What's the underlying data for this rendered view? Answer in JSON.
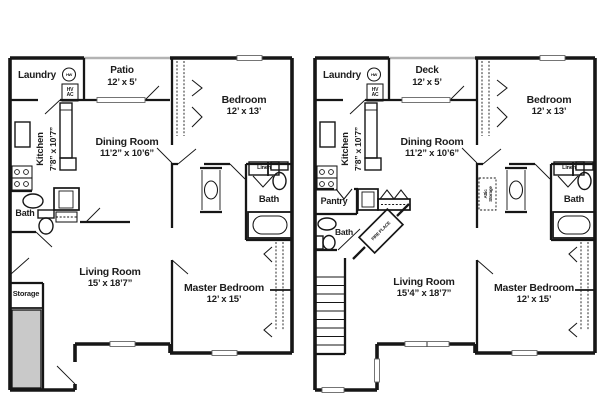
{
  "colors": {
    "background": "#ffffff",
    "walls": "#161616",
    "storage_fill": "#c9c9c9",
    "rail": "#b3b3b3"
  },
  "units": [
    {
      "laundry": "Laundry",
      "hw": "HW",
      "hv": "HV",
      "ac": "AC",
      "outdoor_name": "Patio",
      "outdoor_dims": "12’ x 5’",
      "bedroom_name": "Bedroom",
      "bedroom_dims": "12’ x 13’",
      "kitchen_name": "Kitchen",
      "kitchen_dims": "7’8” x 10’7”",
      "dining_name": "Dining Room",
      "dining_dims": "11’2” x 10’6”",
      "linen": "Linen",
      "bath_upper": "Bath",
      "bath_lower": "Bath",
      "storage": "Storage",
      "living_name": "Living Room",
      "living_dims": "15’ x 18’7”",
      "master_name": "Master Bedroom",
      "master_dims": "12’ x 15’"
    },
    {
      "laundry": "Laundry",
      "hw": "HW",
      "hv": "HV",
      "ac": "AC",
      "outdoor_name": "Deck",
      "outdoor_dims": "12’ x 5’",
      "bedroom_name": "Bedroom",
      "bedroom_dims": "12’ x 13’",
      "kitchen_name": "Kitchen",
      "kitchen_dims": "7’8” x 10’7”",
      "dining_name": "Dining Room",
      "dining_dims": "11’2” x 10’6”",
      "pantry": "Pantry",
      "attic": "Attic Storage",
      "fireplace": "FIRE PLACE",
      "linen": "Linen",
      "bath_upper": "Bath",
      "bath_lower": "Bath",
      "living_name": "Living Room",
      "living_dims": "15’4” x 18’7”",
      "master_name": "Master Bedroom",
      "master_dims": "12’ x 15’"
    }
  ]
}
